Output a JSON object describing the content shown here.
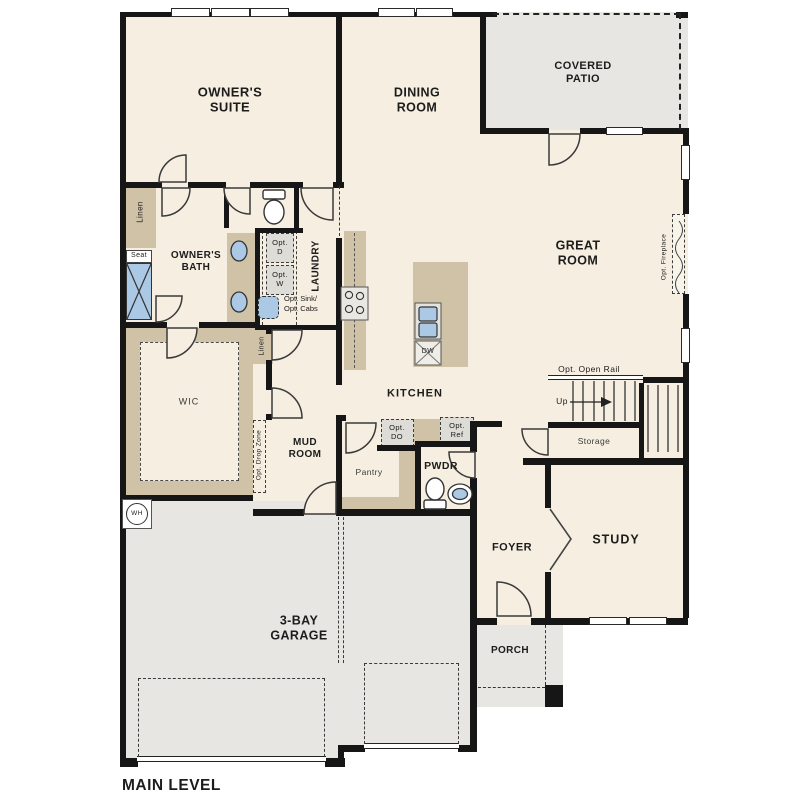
{
  "plan_title": "MAIN LEVEL",
  "colors": {
    "wall": "#161616",
    "interior_floor": "#f6efe1",
    "outdoor_concrete": "#e7e6e2",
    "casework_tan": "#cfc2a7",
    "fixture_blue": "#abc8e5",
    "appliance_gray": "#dddcd6"
  },
  "rooms": {
    "owners_suite": "OWNER'S\nSUITE",
    "dining_room": "DINING\nROOM",
    "covered_patio": "COVERED\nPATIO",
    "great_room": "GREAT\nROOM",
    "owners_bath": "OWNER'S\nBATH",
    "laundry": "LAUNDRY",
    "wic": "WIC",
    "kitchen": "KITCHEN",
    "mud_room": "MUD\nROOM",
    "pantry": "Pantry",
    "powder": "PWDR",
    "foyer": "FOYER",
    "study": "STUDY",
    "storage": "Storage",
    "garage": "3-BAY\nGARAGE",
    "porch": "PORCH"
  },
  "annotations": {
    "linen_bath": "Linen",
    "linen_hall": "Linen",
    "seat": "Seat",
    "opt_dryer": "Opt.\nD",
    "opt_washer": "Opt.\nW",
    "opt_sink_cabs": "Opt. Sink/\nOpt. Cabs",
    "opt_double_oven": "Opt.\nDO",
    "opt_refrigerator": "Opt.\nRef",
    "opt_drop_zone": "Opt. Drop Zone",
    "opt_fireplace": "Opt. Fireplace",
    "opt_open_rail": "Opt. Open Rail",
    "stairs_up": "Up",
    "dishwasher": "DW",
    "water_heater": "WH"
  }
}
